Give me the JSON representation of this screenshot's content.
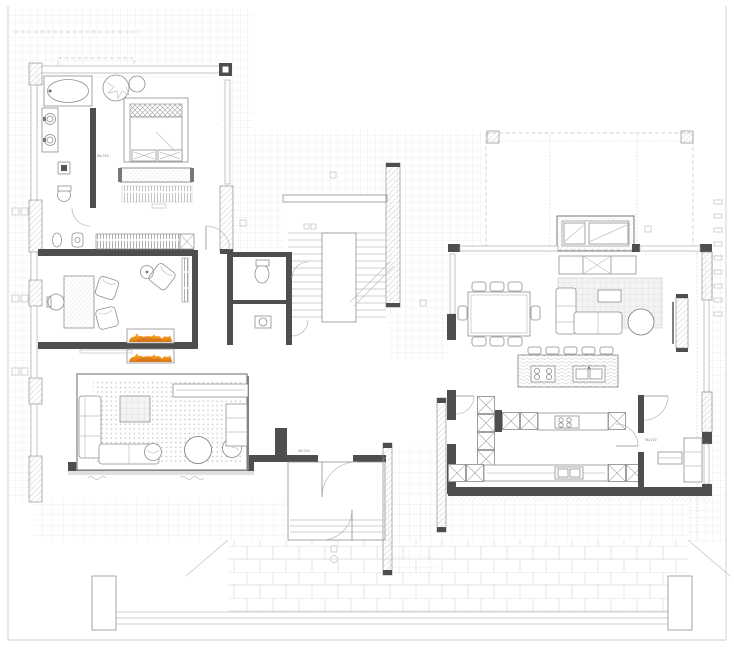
{
  "meta": {
    "drawing_type": "architectural floor plan"
  },
  "colors": {
    "paper": "#ffffff",
    "line": "#8e8e8e",
    "line_light": "#c0c0c0",
    "wall_dark": "#4e4e4e",
    "wall_mid": "#8a8a8a",
    "hatch_line": "#b9b9b9",
    "tile_line": "#e0e0e0",
    "paver_line": "#d9d9d9",
    "rug_dot": "#b2b2b2",
    "flame_light": "#f8b33c",
    "flame_mid": "#f2921d",
    "flame_deep": "#d9731a"
  },
  "annotations": {
    "door_tags": [
      {
        "text": "90/210"
      },
      {
        "text": "90/210"
      },
      {
        "text": "80/210"
      }
    ]
  },
  "areas": [
    "exterior-paving",
    "courtyard",
    "pergola-terrace",
    "master-bathroom",
    "master-bedroom",
    "study",
    "living-room",
    "hallway",
    "wc",
    "staircase",
    "entry-vestibule",
    "dining-area",
    "family-area",
    "kitchen-island",
    "kitchen-run",
    "mudroom",
    "entry-court"
  ],
  "symbols": {
    "bathtub": "oval-in-rect",
    "wash-basin": "double-circle",
    "toilet": "ellipse-with-tank",
    "shower-drain": "square-in-square",
    "bed": "rect-with-lattice-headboard",
    "wardrobe": "tick-band",
    "fireplace-flames": "orange-flame-band",
    "stair": "parallel-treads",
    "dining-table": "rect-with-8-chairs",
    "kitchen-island": "wave-hatch-rect",
    "sink": "double-basin",
    "hob": "four-burner-circles",
    "tall-cabinet": "x-cross-cell",
    "rug": "dot-grid",
    "outdoor-grill": "brick-box",
    "door": "quarter-arc"
  }
}
